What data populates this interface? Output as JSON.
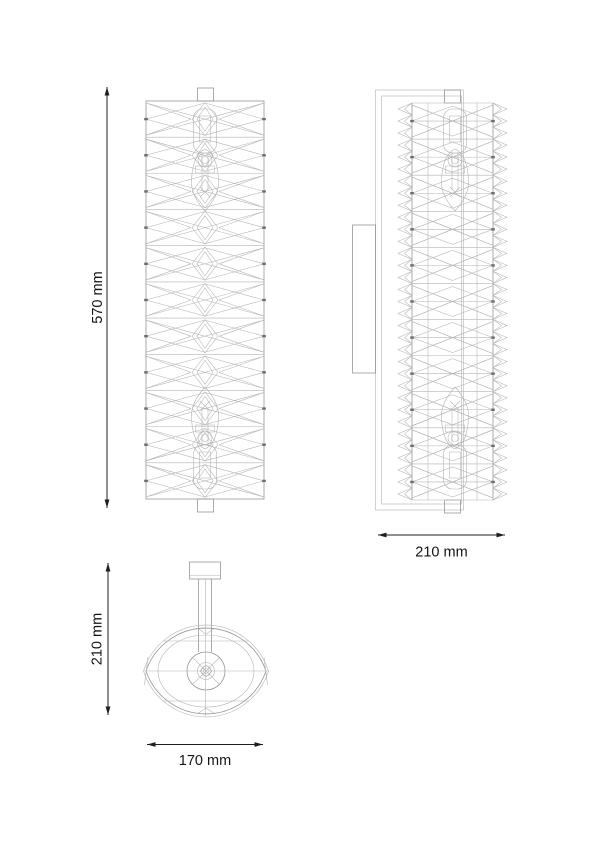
{
  "drawing": {
    "background": "#ffffff",
    "line_light": "#b3b3b3",
    "line_mid": "#969696",
    "line_dark": "#6e6e6e",
    "dimension_color": "#1f1f1f"
  },
  "dimensions": {
    "front_height": {
      "label": "570 mm",
      "orientation": "vertical"
    },
    "side_depth": {
      "label": "210 mm",
      "orientation": "horizontal"
    },
    "plan_depth": {
      "label": "210 mm",
      "orientation": "vertical"
    },
    "plan_width": {
      "label": "170 mm",
      "orientation": "horizontal"
    }
  }
}
